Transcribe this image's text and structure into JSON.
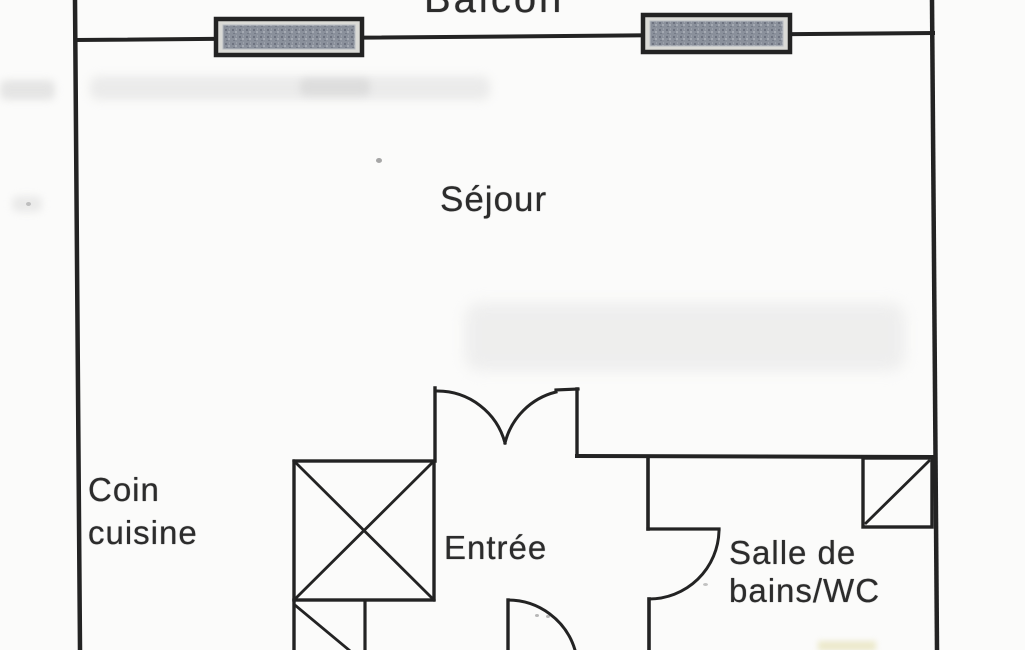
{
  "labels": {
    "balcony": "Balcon",
    "living_room": "Séjour",
    "kitchen_line1": "Coin",
    "kitchen_line2": "cuisine",
    "entrance": "Entrée",
    "bathroom_line1": "Salle de",
    "bathroom_line2": "bains/WC"
  },
  "colors": {
    "ink": "#232323",
    "text": "#2c2c2c",
    "paper": "#fbfbfa",
    "windowFill": "#878d98"
  },
  "diagram": {
    "type": "floor-plan",
    "rooms": [
      {
        "name": "Balcon",
        "note": "balcony, clipped at top edge"
      },
      {
        "name": "Séjour",
        "note": "living room with two windows on facade"
      },
      {
        "name": "Coin cuisine",
        "note": "kitchenette, left side"
      },
      {
        "name": "Entrée",
        "note": "entrance hall with double-door to living room"
      },
      {
        "name": "Salle de bains/WC",
        "note": "bathroom with swing door and corner duct"
      }
    ]
  }
}
